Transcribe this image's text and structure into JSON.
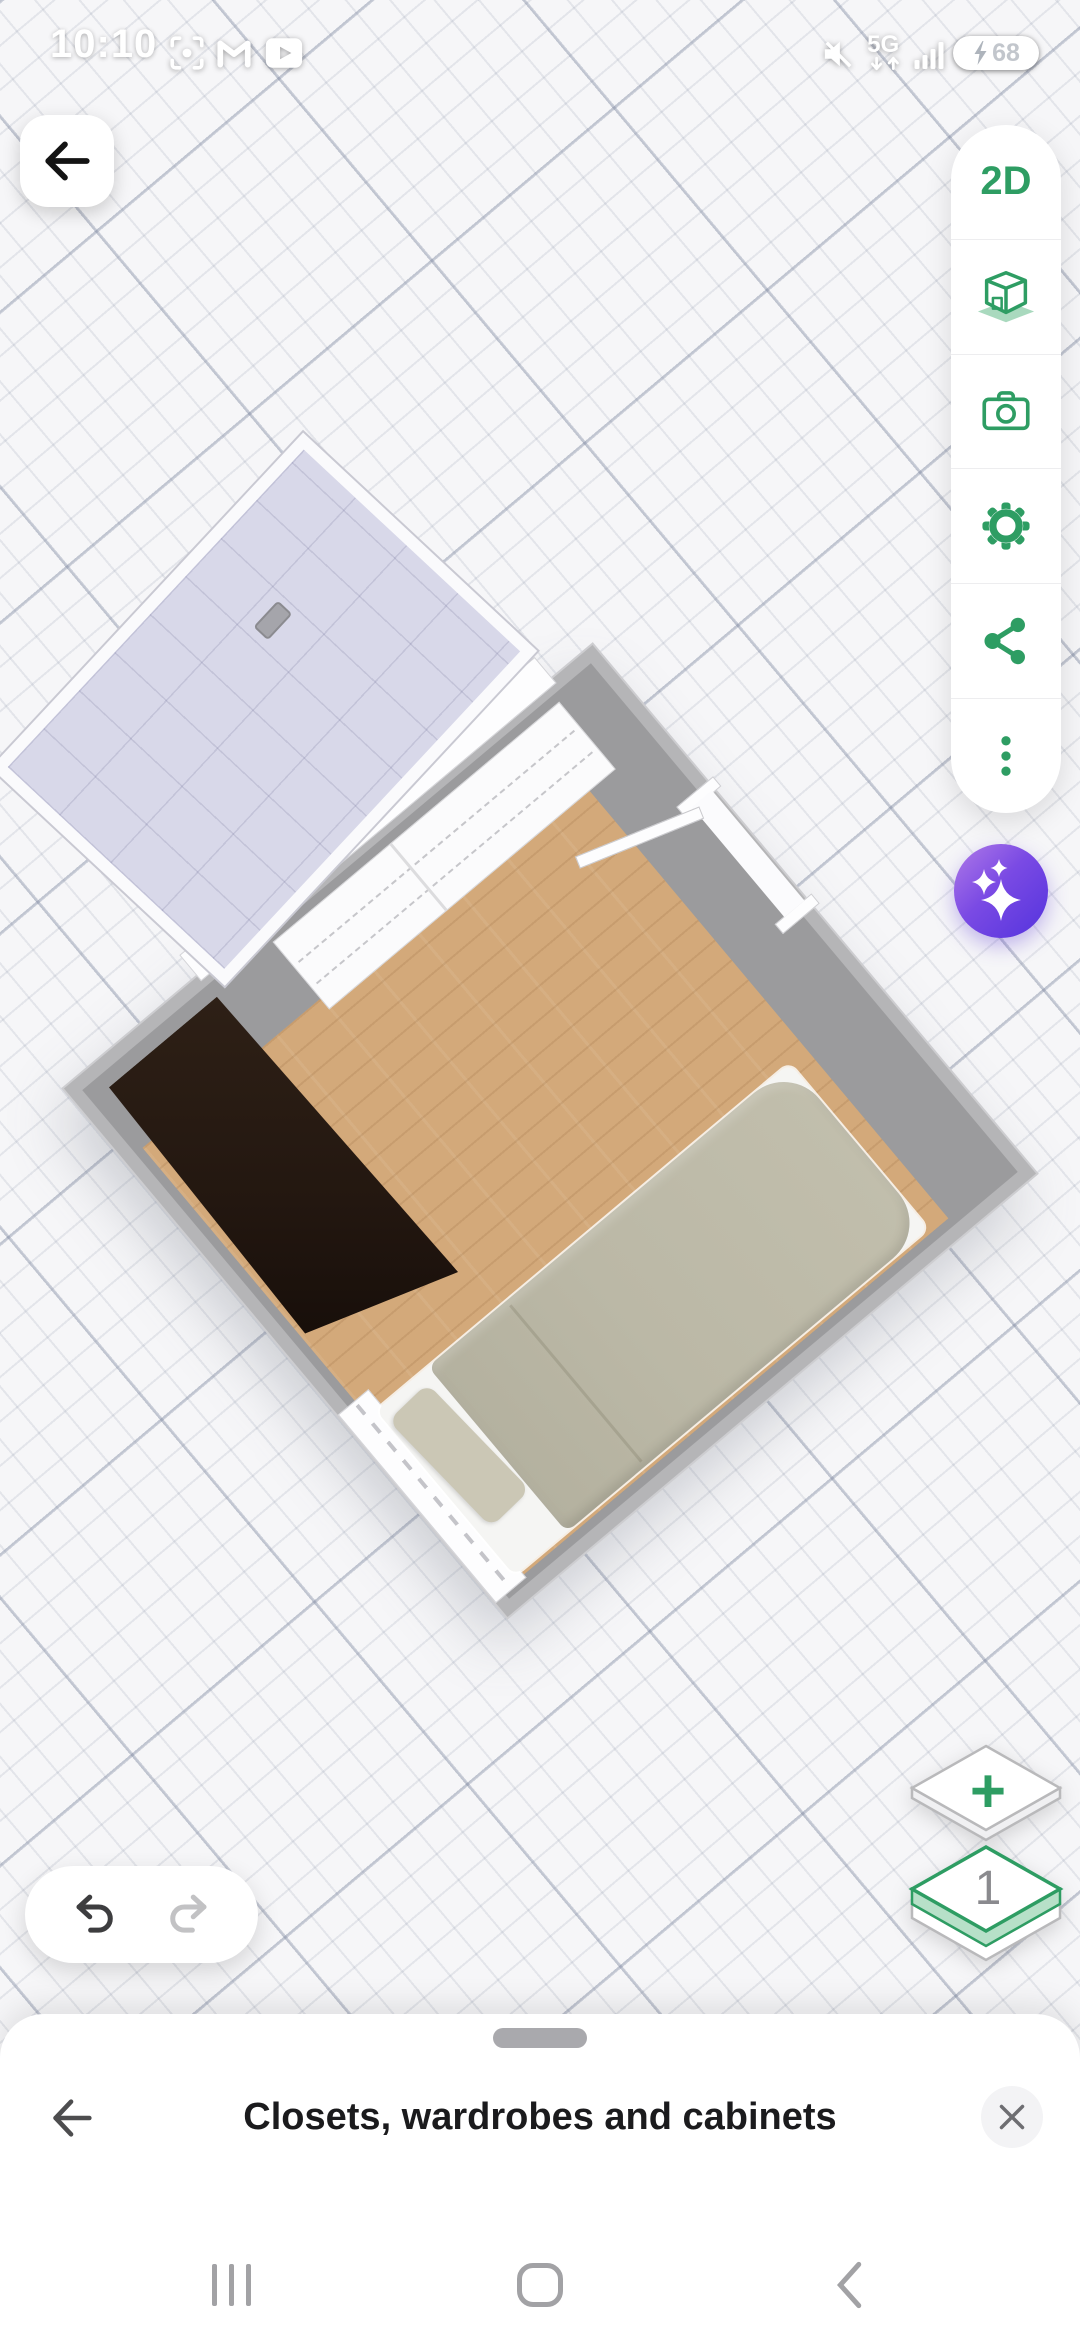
{
  "status_bar": {
    "time": "10:10",
    "network_label": "5G",
    "battery_percent": "68",
    "left_icons": [
      "screenshot-icon",
      "gmail-icon",
      "youtube-icon"
    ],
    "right_icons": [
      "mute-icon",
      "network-5g-icon",
      "signal-icon",
      "battery-icon"
    ]
  },
  "top_left": {
    "back_icon": "arrow-left-icon"
  },
  "toolbar": {
    "view_toggle_label": "2D",
    "icons": [
      "cube-3d-icon",
      "camera-icon",
      "gear-icon",
      "share-icon",
      "more-dots-icon"
    ]
  },
  "ai_button": {
    "icon": "sparkles-icon",
    "gradient_start": "#b07ae8",
    "gradient_end": "#5433dd"
  },
  "floor_selector": {
    "add_label": "+",
    "current_floor": "1"
  },
  "history_controls": {
    "undo_icon": "undo-icon",
    "redo_icon": "redo-icon"
  },
  "canvas": {
    "furniture": [
      "window-glass-panel",
      "closet-shelving-unit",
      "corner-wardrobe-dark",
      "single-bed",
      "door",
      "small-window"
    ],
    "floor_color": "#d3a97a",
    "wall_color": "#9b9b9d",
    "wardrobe_color": "#231710",
    "bed_blanket_color": "#bbb8a6"
  },
  "bottom_sheet": {
    "title": "Closets, wardrobes and cabinets"
  },
  "nav_bar": {
    "icons": [
      "recents-icon",
      "home-icon",
      "back-chevron-icon"
    ]
  },
  "colors": {
    "accent_green": "#2E9D63",
    "accent_green_light": "#A9D9BE",
    "grid_bg": "#f6f6f8"
  }
}
